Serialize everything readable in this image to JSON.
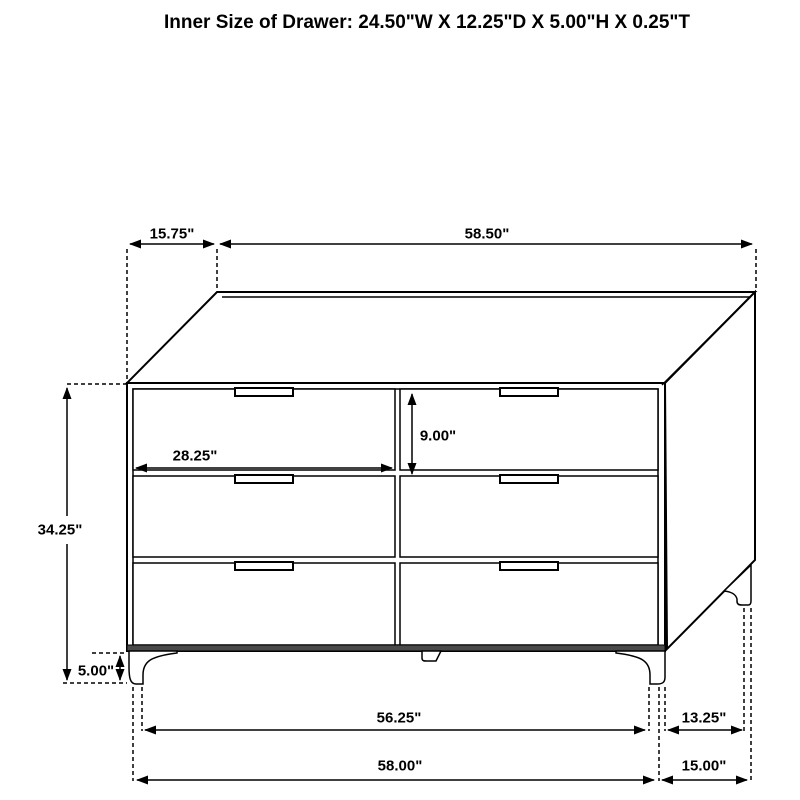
{
  "title": "Inner Size of Drawer: 24.50\"W X 12.25\"D X 5.00\"H X 0.25\"T",
  "dimensions": {
    "top_depth": "15.75\"",
    "top_width": "58.50\"",
    "overall_height": "34.25\"",
    "drawer_front_width": "28.25\"",
    "drawer_front_height": "9.00\"",
    "leg_height": "5.00\"",
    "bottom_inner_width": "56.25\"",
    "bottom_outer_width": "58.00\"",
    "side_inner_depth": "13.25\"",
    "side_outer_depth": "15.00\""
  },
  "colors": {
    "line": "#000000",
    "background": "#ffffff",
    "bottom_band": "#4a4a4a"
  }
}
